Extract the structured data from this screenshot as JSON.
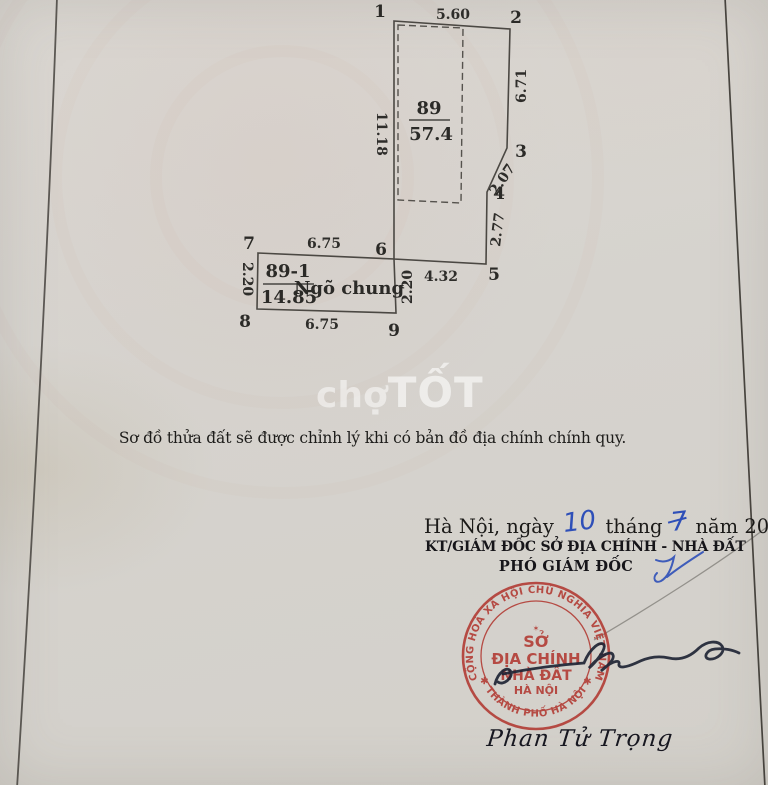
{
  "diagram": {
    "vertex_labels": [
      "1",
      "2",
      "3",
      "4",
      "5",
      "6",
      "7",
      "8",
      "9"
    ],
    "dims": {
      "top": "5.60",
      "right_upper": "6.71",
      "diag": "2.07",
      "right_lower": "2.77",
      "bottom": "4.32",
      "left": "11.18",
      "alley_top": "6.75",
      "alley_bottom": "6.75",
      "alley_left": "2.20",
      "alley_right": "2.20"
    },
    "plot_main": {
      "id": "89",
      "area": "57.4"
    },
    "plot_alley": {
      "id": "89-1",
      "area": "14.85",
      "label": "Ngõ chung"
    }
  },
  "watermark": {
    "light": "chợ",
    "bold": "TỐT"
  },
  "caption": "Sơ đồ thửa đất sẽ được chỉnh lý khi có bản đồ địa chính chính quy.",
  "signing": {
    "date_prefix": "Hà Nội, ngày",
    "date_day": "10",
    "date_mid": "tháng",
    "date_month": "7",
    "date_suffix": "năm 2002",
    "title_line1": "KT/GIÁM ĐỐC SỞ ĐỊA CHÍNH - NHÀ ĐẤT",
    "title_line2": "PHÓ GIÁM ĐỐC",
    "signer_name": "Phan Tử Trọng"
  },
  "stamp": {
    "rim_top": "CỘNG HOÀ XÃ HỘI CHỦ NGHĨA VIỆT NAM",
    "rim_bottom": "✱ THÀNH PHỐ HÀ NỘI ✱",
    "center_line1": "SỞ",
    "center_line2": "ĐỊA CHÍNH",
    "center_line3": "NHÀ ĐẤT",
    "center_line4": "HÀ NỘI",
    "star": "✶"
  },
  "colors": {
    "stamp_red": "#b13831",
    "ink_blue": "#2e4fb8",
    "line": "#4b4843"
  }
}
